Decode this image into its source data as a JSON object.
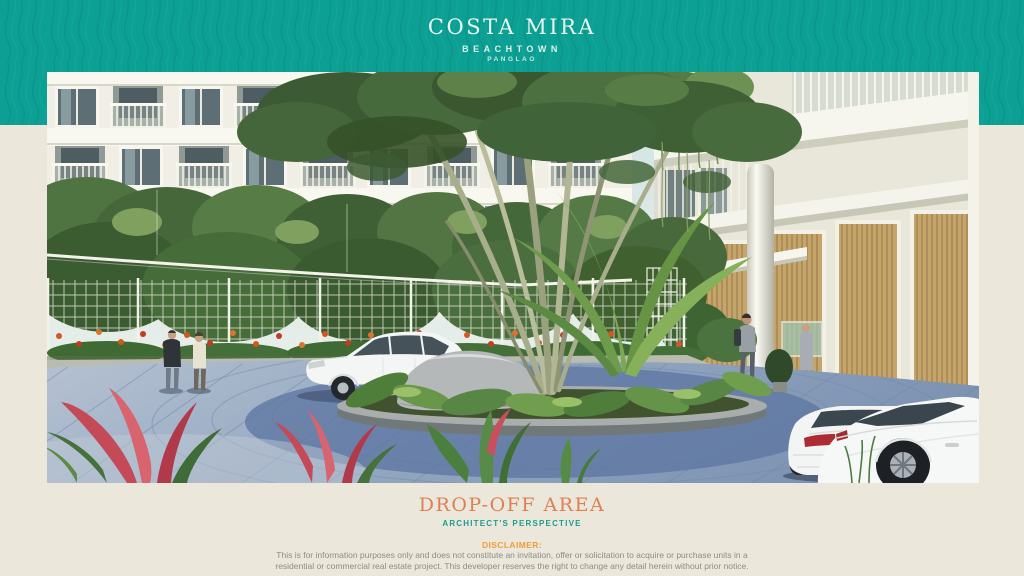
{
  "brand": {
    "title": "COSTA MIRA",
    "subtitle": "BEACHTOWN",
    "location": "PANGLAO"
  },
  "caption": {
    "title": "DROP-OFF AREA",
    "subtitle": "ARCHITECT'S PERSPECTIVE"
  },
  "disclaimer": {
    "label": "DISCLAIMER:",
    "line1": "This is for information purposes only and does not constitute an invitation, offer or solicitation to acquire or purchase units in a",
    "line2": "residential or commercial real estate project. This developer reserves the right to change any detail herein without prior notice."
  },
  "hero": {
    "image_label": "Drop-off area architect's perspective rendering"
  },
  "colors": {
    "banner_teal": "#0CA094",
    "banner_pattern_dark": "#0A8F81",
    "page_background": "#EBE7DB",
    "heading_orange": "#DE8054",
    "subtitle_teal": "#1E9C8E",
    "disclaimer_orange": "#EF9B3D",
    "disclaimer_gray": "#8D8D84",
    "logo_text": "#E8F6EF"
  }
}
